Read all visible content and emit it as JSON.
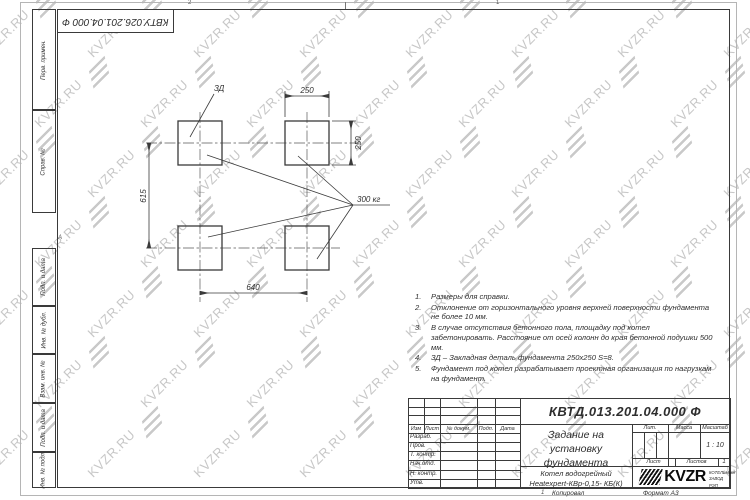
{
  "watermark": {
    "text": "KVZR.RU",
    "color": "#c7c7c7"
  },
  "frame": {
    "top_stamp": "КВТУ.026.201.04.000 Ф",
    "zone_top_2": "2",
    "zone_top_1": "1",
    "zone_left_a": "А",
    "margin_boxes": [
      "Перв. примен.",
      "Справ. №",
      "Подп. и дата",
      "Инв. № дубл.",
      "Взам. инв. №",
      "Подп. и дата",
      "Инв. № подл."
    ],
    "footer_zone": "1",
    "footer_copied": "Копировал",
    "footer_format": "Формат А3"
  },
  "drawing": {
    "detail_label": "ЗД",
    "load_label": "300 кг",
    "dim_top": "250",
    "dim_right": "250",
    "dim_left": "615",
    "dim_bottom": "640"
  },
  "notes": [
    {
      "n": "1.",
      "text": "Размеры для справки."
    },
    {
      "n": "2.",
      "text": "Отклонение от горизонтального уровня верхней поверхности фундамента не более 10 мм."
    },
    {
      "n": "3.",
      "text": "В случае отсутствия бетонного пола, площадку под котел забетонировать. Расстояние от осей колонн до края бетонной подушки 500 мм."
    },
    {
      "n": "4.",
      "text": "ЗД – Закладная деталь фундамента 250х250 S=8."
    },
    {
      "n": "5.",
      "text": "Фундамент под котел разрабатывает проектная организация по нагрузкам на фундамент."
    }
  ],
  "title_block": {
    "doc_number": "КВТД.013.201.04.000 Ф",
    "title_line1": "Задание на установку",
    "title_line2": "фундамента",
    "product_line1": "Котел водогрейный",
    "product_line2": "Heatexpert-КВр-0,15- КБ(К)",
    "col_izm": "Изм",
    "col_list": "Лист",
    "col_doc": "№ докум.",
    "col_podp": "Подп.",
    "col_data": "Дата",
    "rows": [
      "Разраб.",
      "Пров.",
      "Т. контр.",
      "Нач.отд.",
      "Н. контр.",
      "Утв."
    ],
    "lit_label": "Лит.",
    "mass_label": "Масса",
    "scale_label": "Масштаб",
    "scale_value": "1 : 10",
    "sheet_label": "Лист",
    "sheets_label": "Листов",
    "sheets_value": "1",
    "logo_text": "KVZR",
    "logo_sub1": "КОТЕЛЬНЫЙ",
    "logo_sub2": "ЗАВОД РЭП"
  }
}
